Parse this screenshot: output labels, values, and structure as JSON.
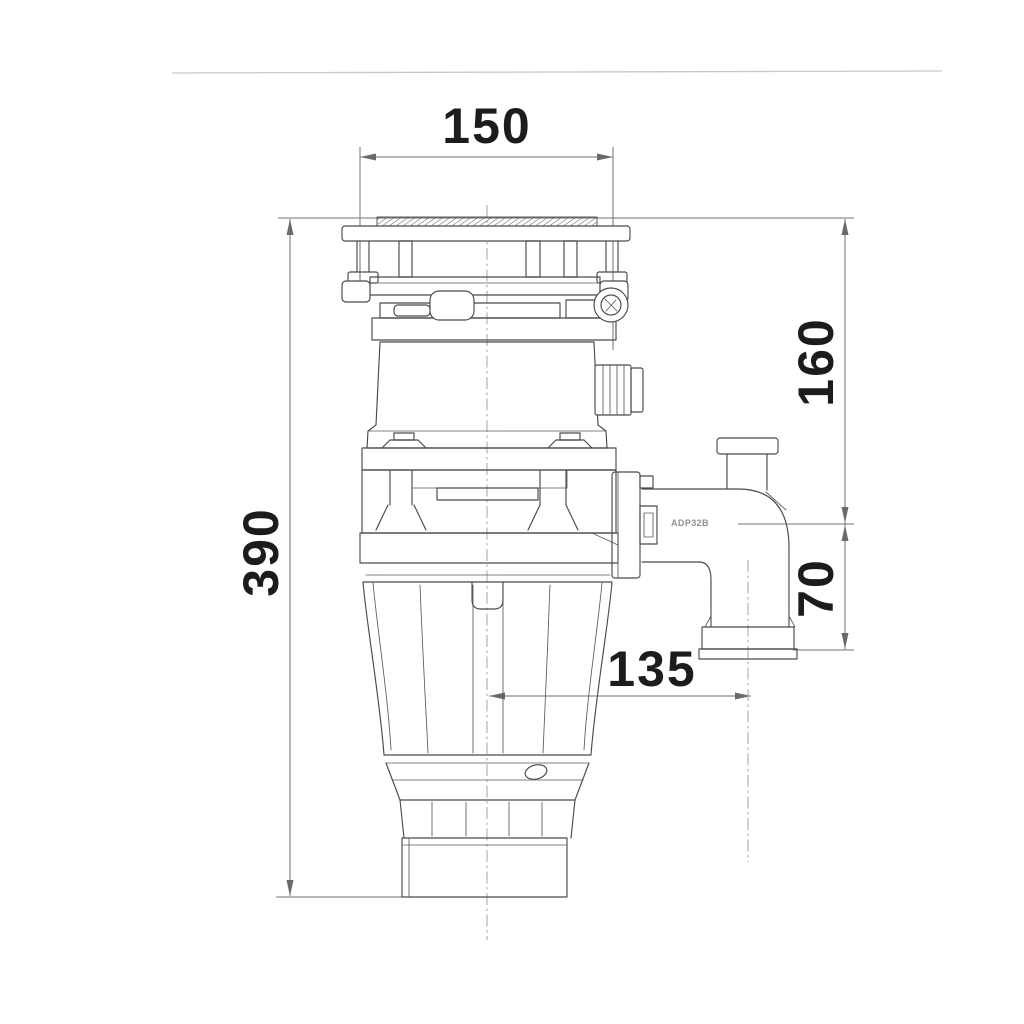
{
  "drawing": {
    "part_code": "ADP32B",
    "dimensions": {
      "flange_width": "150",
      "overall_height": "390",
      "flange_to_outlet_centre": "160",
      "outlet_centre_to_end": "70",
      "centre_to_outlet_offset": "135"
    }
  },
  "colors": {
    "body_line": "#4a4a4a",
    "dimension_line": "#707070",
    "dimension_text": "#1c1c1c",
    "part_code_text": "#8f8f8f",
    "background": "#ffffff"
  }
}
